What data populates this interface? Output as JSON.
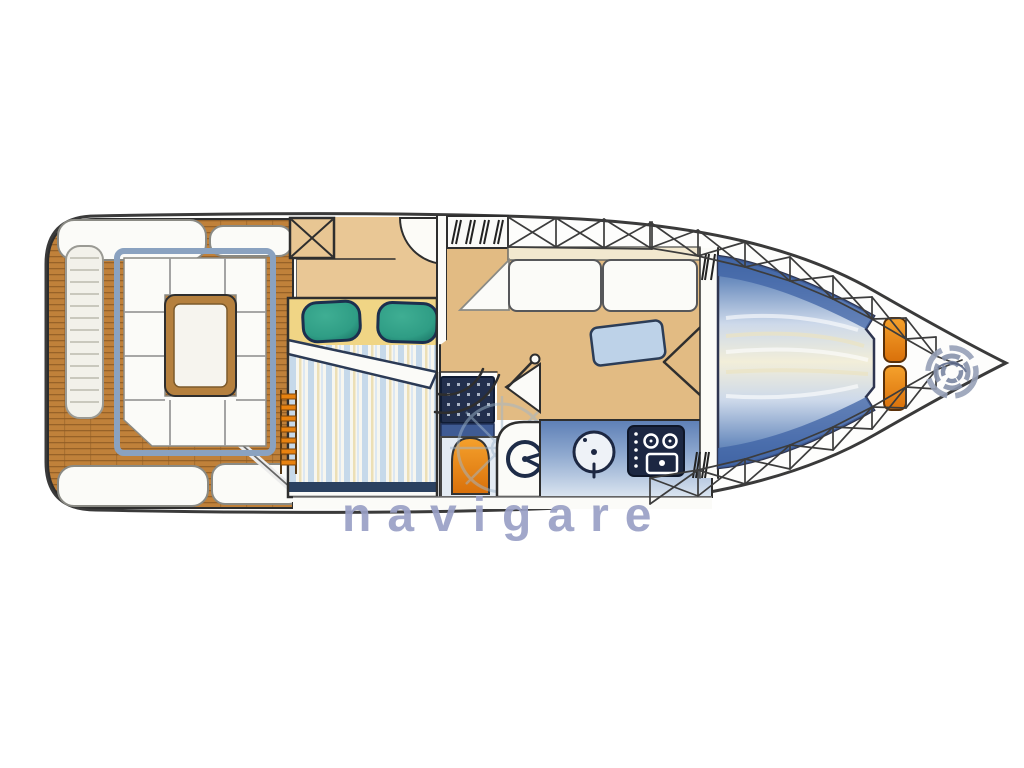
{
  "figure": {
    "kind": "yacht deck plan watercolor illustration",
    "orientation": "bow pointing right",
    "watermark": {
      "text": "navigare",
      "color": "#9aa0c6"
    }
  },
  "palette": {
    "hull-line": "#3a3a3a",
    "teak": "#c0813a",
    "teak-line": "#7c4c1c",
    "floor-tan": "#e2bb83",
    "roof-tan": "#e9c795",
    "headboard-yellow": "#f0d585",
    "pillow-teal": "#2f9d85",
    "bed-stripe-blue": "#c3d7ea",
    "berth-blue": "#46699f",
    "counter-blue": "#5d7fb6",
    "accent-orange": "#e8820f",
    "appliance-navy": "#1c2742",
    "frame-blue": "#8aa2c0",
    "watermark-blue": "#9aa0c6"
  },
  "components": [
    "swim-platform",
    "cockpit-seating",
    "cockpit-table",
    "companionway-steps",
    "deck-hatch",
    "double-bed",
    "teal-pillows",
    "shower-grate",
    "toilet",
    "helm-wheel",
    "galley-sink",
    "stove-burners",
    "salon-sofa",
    "salon-table",
    "v-berth",
    "bow-cushions",
    "anchor-rope-coil",
    "side-deck-truss"
  ]
}
